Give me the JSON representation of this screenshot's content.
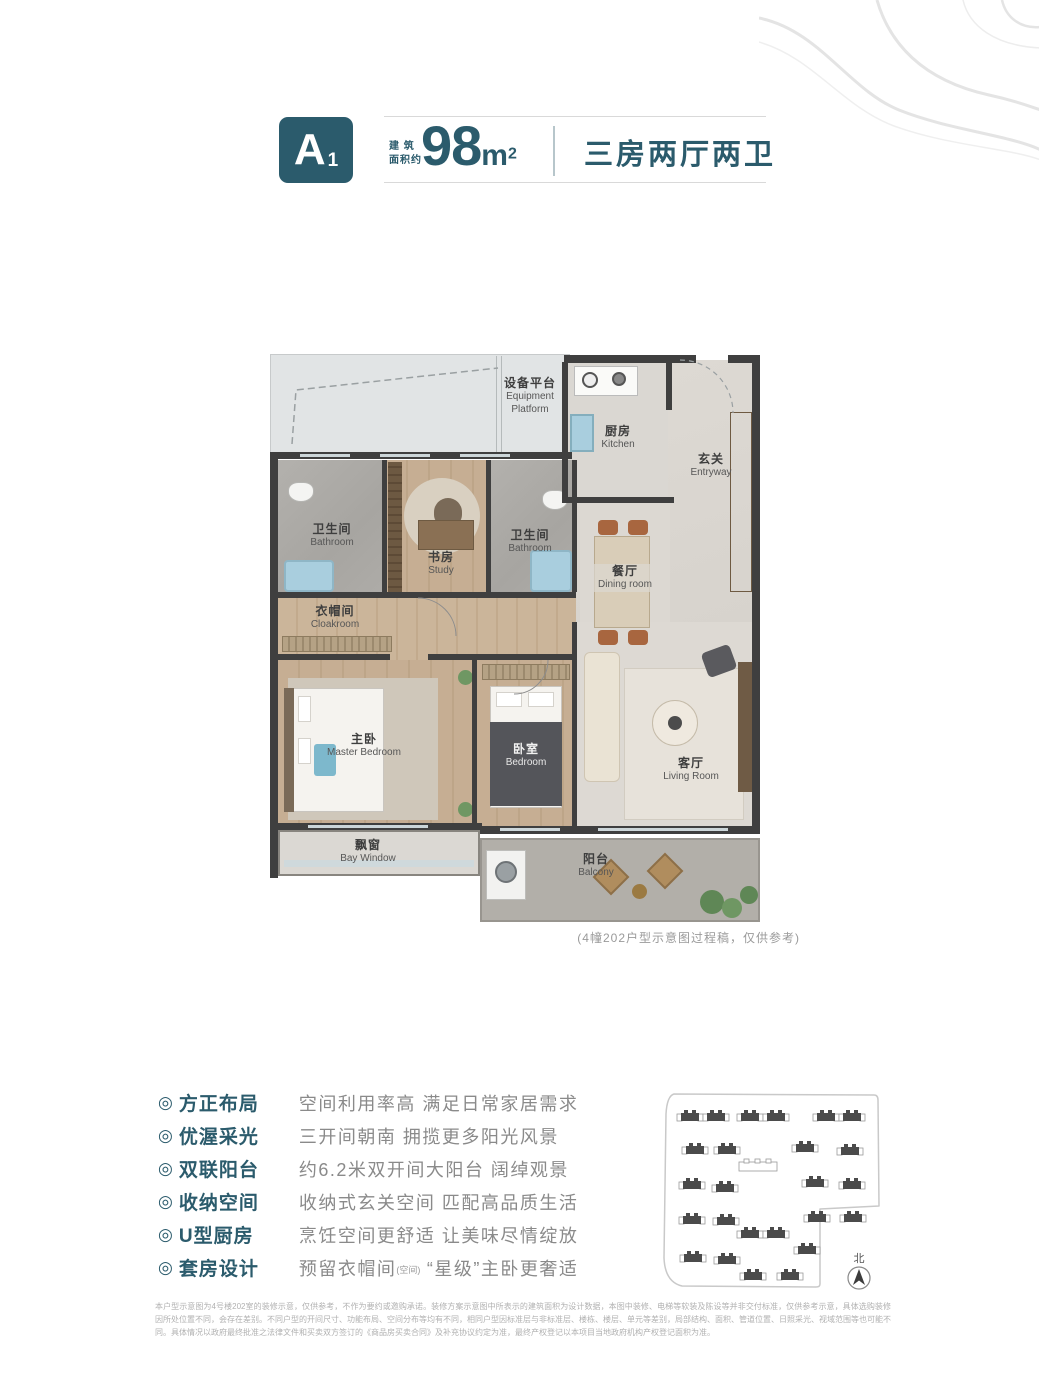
{
  "header": {
    "badge_main": "A",
    "badge_sub": "1",
    "area_label_l1": "建 筑",
    "area_label_l2": "面积约",
    "area_value": "98",
    "area_unit": "m",
    "area_unit_exp": "2",
    "layout_title": "三房两厅两卫"
  },
  "floor_plan": {
    "caption": "(4幢202户型示意图过程稿，仅供参考)",
    "rooms": {
      "equipment": {
        "cn": "设备平台",
        "en": "Equipment\nPlatform"
      },
      "kitchen": {
        "cn": "厨房",
        "en": "Kitchen"
      },
      "entryway": {
        "cn": "玄关",
        "en": "Entryway"
      },
      "bathroom_left": {
        "cn": "卫生间",
        "en": "Bathroom"
      },
      "study": {
        "cn": "书房",
        "en": "Study"
      },
      "bathroom_mid": {
        "cn": "卫生间",
        "en": "Bathroom"
      },
      "dining": {
        "cn": "餐厅",
        "en": "Dining room"
      },
      "cloakroom": {
        "cn": "衣帽间",
        "en": "Cloakroom"
      },
      "master": {
        "cn": "主卧",
        "en": "Master Bedroom"
      },
      "bedroom": {
        "cn": "卧室",
        "en": "Bedroom"
      },
      "living": {
        "cn": "客厅",
        "en": "Living Room"
      },
      "bay": {
        "cn": "飘窗",
        "en": "Bay Window"
      },
      "balcony": {
        "cn": "阳台",
        "en": "Balcony"
      }
    }
  },
  "features": {
    "bullet": "◎",
    "items": [
      {
        "title": "方正布局",
        "desc": "空间利用率高 满足日常家居需求"
      },
      {
        "title": "优渥采光",
        "desc": "三开间朝南 拥揽更多阳光风景"
      },
      {
        "title": "双联阳台",
        "desc": "约6.2米双开间大阳台 阔绰观景"
      },
      {
        "title": "收纳空间",
        "desc": "收纳式玄关空间 匹配高品质生活"
      },
      {
        "title": "U型厨房",
        "desc": "烹饪空间更舒适 让美味尽情绽放"
      },
      {
        "title": "套房设计",
        "desc_pre": "预留衣帽间",
        "desc_small": "(空间)",
        "desc_post": "“星级”主卧更奢适"
      }
    ]
  },
  "site_plan": {
    "north_label": "北",
    "buildings": [
      {
        "t": "pair",
        "x": 25,
        "y": 24
      },
      {
        "t": "pair",
        "x": 85,
        "y": 24
      },
      {
        "t": "pair",
        "x": 161,
        "y": 24
      },
      {
        "t": "single",
        "x": 30,
        "y": 57
      },
      {
        "t": "single",
        "x": 62,
        "y": 57
      },
      {
        "t": "single",
        "x": 140,
        "y": 55
      },
      {
        "t": "single",
        "x": 185,
        "y": 58
      },
      {
        "t": "outline",
        "x": 87,
        "y": 73
      },
      {
        "t": "single",
        "x": 27,
        "y": 92
      },
      {
        "t": "single",
        "x": 60,
        "y": 95
      },
      {
        "t": "single",
        "x": 150,
        "y": 90
      },
      {
        "t": "single",
        "x": 187,
        "y": 92
      },
      {
        "t": "single",
        "x": 27,
        "y": 127
      },
      {
        "t": "single",
        "x": 61,
        "y": 128
      },
      {
        "t": "single",
        "x": 152,
        "y": 125
      },
      {
        "t": "single",
        "x": 188,
        "y": 125
      },
      {
        "t": "pair",
        "x": 85,
        "y": 141
      },
      {
        "t": "single",
        "x": 142,
        "y": 157
      },
      {
        "t": "single",
        "x": 28,
        "y": 165
      },
      {
        "t": "single",
        "x": 62,
        "y": 167
      },
      {
        "t": "single",
        "x": 88,
        "y": 183
      },
      {
        "t": "single",
        "x": 125,
        "y": 183
      }
    ]
  },
  "disclaimer": "本户型示意图为4号楼202室的装修示意，仅供参考，不作为要约或邀购承诺。装修方案示意图中所表示的建筑面积为设计数据，本图中装修、电梯等软装及陈设等并非交付标准，仅供参考示意，具体选购装修因所处位置不同，会存在差别。不同户型的开间尺寸、功能布局、空间分布等均有不同，相同户型因标准层与非标准层、楼栋、楼层、单元等差别，局部结构、面积、管道位置、日照采光、视域范围等也可能不同。具体情况以政府最终批准之法律文件和买卖双方签订的《商品房买卖合同》及补充协议约定为准，最终产权登记以本项目当地政府机构产权登记面积为准。"
}
